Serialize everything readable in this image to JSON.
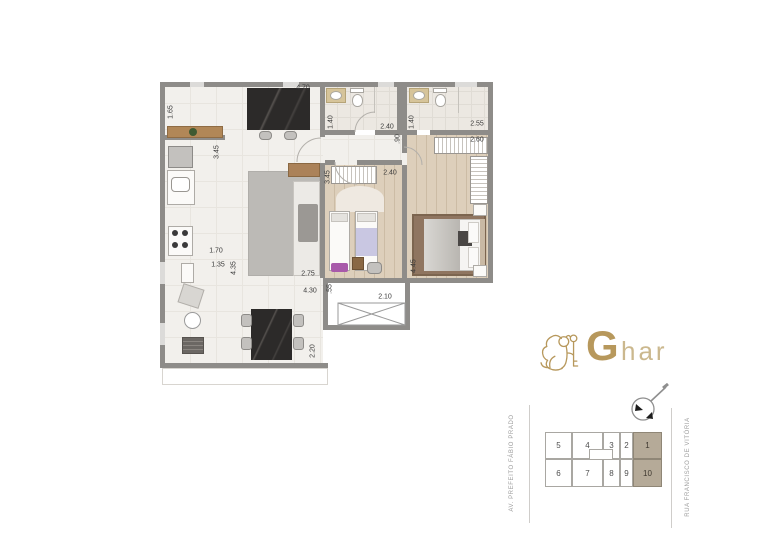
{
  "logo": {
    "brand_initial": "G",
    "brand_suffix": "har",
    "color_gold": "#b7985c"
  },
  "streets": {
    "left": "AV. PREFEITO FÁBIO PRADO",
    "right": "RUA FRANCISCO DE VITÓRIA"
  },
  "plan": {
    "wall_color": "#8e8c89",
    "floor_tile_color": "#f2f0ec",
    "floor_wood_color": "#ddcfbb",
    "floor_bath_color": "#ece8e2",
    "dimension_labels": [
      {
        "text": "4.70",
        "x": 303,
        "y": 88,
        "rot": false
      },
      {
        "text": "1.65",
        "x": 171,
        "y": 112,
        "rot": true
      },
      {
        "text": "3.45",
        "x": 217,
        "y": 152,
        "rot": true
      },
      {
        "text": "1.40",
        "x": 331,
        "y": 122,
        "rot": true
      },
      {
        "text": "2.40",
        "x": 387,
        "y": 127,
        "rot": false
      },
      {
        "text": "1.40",
        "x": 412,
        "y": 122,
        "rot": true
      },
      {
        "text": "2.55",
        "x": 477,
        "y": 124,
        "rot": false
      },
      {
        "text": "2.60",
        "x": 477,
        "y": 140,
        "rot": false
      },
      {
        "text": ".90",
        "x": 398,
        "y": 139,
        "rot": true
      },
      {
        "text": "3.45",
        "x": 328,
        "y": 177,
        "rot": true
      },
      {
        "text": "2.40",
        "x": 390,
        "y": 173,
        "rot": false
      },
      {
        "text": "4.45",
        "x": 414,
        "y": 266,
        "rot": true
      },
      {
        "text": "2.75",
        "x": 308,
        "y": 274,
        "rot": false
      },
      {
        "text": "4.35",
        "x": 234,
        "y": 268,
        "rot": true
      },
      {
        "text": "1.70",
        "x": 216,
        "y": 251,
        "rot": false
      },
      {
        "text": "1.35",
        "x": 218,
        "y": 265,
        "rot": false
      },
      {
        "text": "4.30",
        "x": 310,
        "y": 291,
        "rot": false
      },
      {
        "text": ".55",
        "x": 330,
        "y": 289,
        "rot": true
      },
      {
        "text": "2.10",
        "x": 385,
        "y": 297,
        "rot": false
      },
      {
        "text": "2.20",
        "x": 313,
        "y": 351,
        "rot": true
      }
    ]
  },
  "keyplan": {
    "highlight_color": "#b5aa98",
    "units": [
      {
        "label": "5",
        "x": 545,
        "y": 432,
        "w": 27,
        "h": 27,
        "hl": false
      },
      {
        "label": "4",
        "x": 572,
        "y": 432,
        "w": 31,
        "h": 27,
        "hl": false
      },
      {
        "label": "3",
        "x": 603,
        "y": 432,
        "w": 17,
        "h": 27,
        "hl": false
      },
      {
        "label": "2",
        "x": 620,
        "y": 432,
        "w": 13,
        "h": 27,
        "hl": false
      },
      {
        "label": "1",
        "x": 633,
        "y": 432,
        "w": 29,
        "h": 27,
        "hl": true
      },
      {
        "label": "6",
        "x": 545,
        "y": 459,
        "w": 27,
        "h": 28,
        "hl": false
      },
      {
        "label": "7",
        "x": 572,
        "y": 459,
        "w": 31,
        "h": 28,
        "hl": false
      },
      {
        "label": "8",
        "x": 603,
        "y": 459,
        "w": 17,
        "h": 28,
        "hl": false
      },
      {
        "label": "9",
        "x": 620,
        "y": 459,
        "w": 13,
        "h": 28,
        "hl": false
      },
      {
        "label": "10",
        "x": 633,
        "y": 459,
        "w": 29,
        "h": 28,
        "hl": true
      }
    ]
  }
}
